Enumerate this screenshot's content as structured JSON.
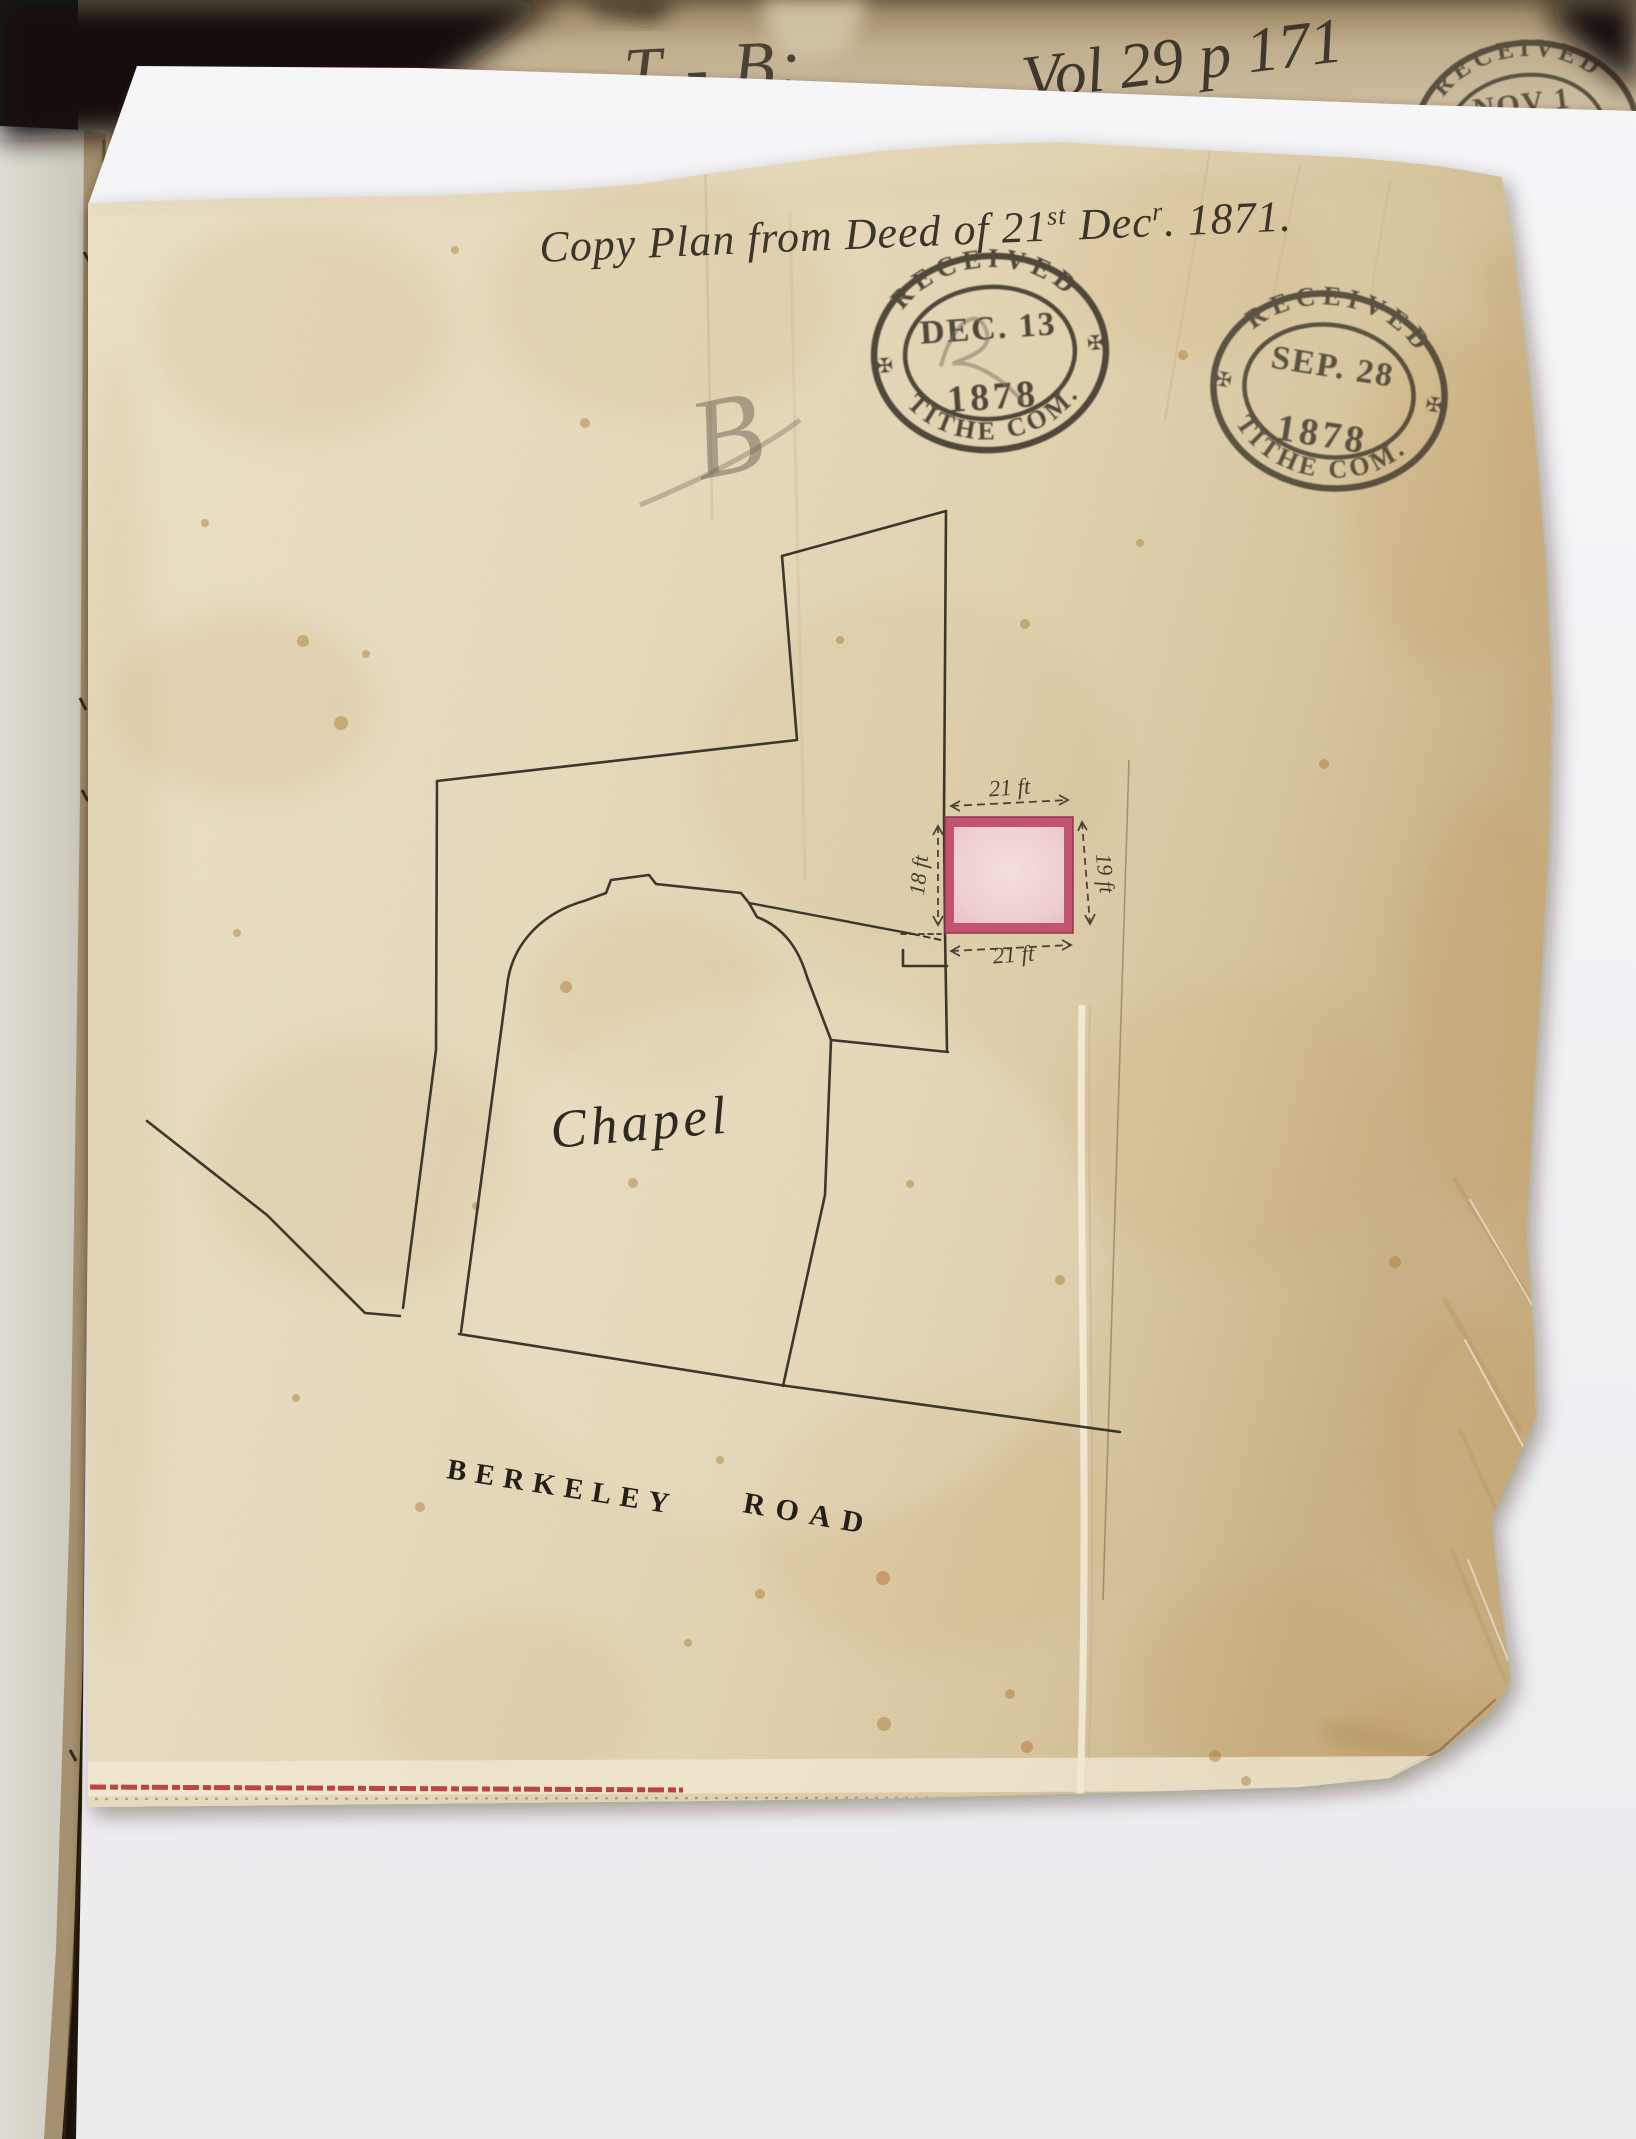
{
  "document": {
    "title": {
      "p1": "Copy Plan from Deed of 21",
      "sup1": "st",
      "p2": " Dec",
      "sup2": "r",
      "p3": ". 1871."
    },
    "pencil_note": "B",
    "plan": {
      "building_label": "Chapel",
      "road_label_word1": "BERKELEY",
      "road_label_word2": "ROAD",
      "parcel": {
        "width_top": "21 ft",
        "width_bottom": "21 ft",
        "depth_left": "18 ft",
        "depth_right": "19 ft"
      }
    }
  },
  "spine_annotations": {
    "classmark": "T - B:",
    "volume_reference": "Vol 29 p 171"
  },
  "stamps": {
    "received_nov": {
      "arc_top": "RECEIVED",
      "line1": "NOV 1",
      "ornament": "✠"
    },
    "received_dec": {
      "arc_top": "RECEIVED",
      "date": "DEC. 13",
      "year": "1878",
      "arc_bottom": "TITHE COM.",
      "ornament": "✠"
    },
    "received_sep": {
      "arc_top": "RECEIVED",
      "date": "SEP. 28",
      "year": "1878",
      "arc_bottom": "TITHE COM.",
      "ornament": "✠"
    }
  },
  "colors": {
    "parcel_fill": "#eccfd1",
    "parcel_border": "#c2546e",
    "selvage_red": "#b33434",
    "plan_ink": "#2e2a22",
    "stamp_ink": "#3a342b",
    "pencil": "#6e6557",
    "linen": "#e8dcbf"
  }
}
